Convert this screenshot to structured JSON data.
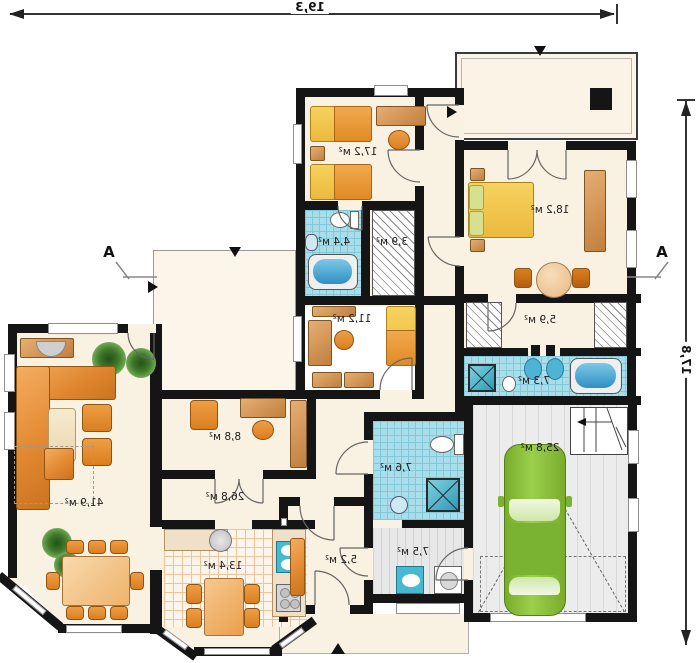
{
  "plan": {
    "dimensions": {
      "width_label": "19,3",
      "height_label": "17,8"
    },
    "section_markers": {
      "left": "A",
      "right": "A"
    },
    "rooms": {
      "children_room_1": {
        "label": "17,2 м²"
      },
      "master_bedroom": {
        "label": "18,2 м²"
      },
      "bathroom_top": {
        "label": "4,4 м²"
      },
      "wardrobe_top": {
        "label": "3,9 м²"
      },
      "children_room_2": {
        "label": "11,2 м²"
      },
      "dressing": {
        "label": "5,9 м²"
      },
      "master_bath": {
        "label": "7,3 м²"
      },
      "garage": {
        "label": "25,8 м²"
      },
      "bathroom_main": {
        "label": "7,6 м²"
      },
      "utility": {
        "label": "7,5 м²"
      },
      "hall": {
        "label": "5,2 м²"
      },
      "corridor": {
        "label": "26,8 м²"
      },
      "study": {
        "label": "8,8 м²"
      },
      "living_room": {
        "label": "41,9 м²"
      },
      "kitchen": {
        "label": "13,4 м²"
      }
    },
    "colors": {
      "wall": "#151515",
      "floor": "#f9f1e1",
      "bath_tile": "#a9dde9",
      "furniture_orange": "#e0862f",
      "bed_yellow": "#f0c24a",
      "car_green": "#8cc63f",
      "garage_floor": "#ececec"
    }
  }
}
